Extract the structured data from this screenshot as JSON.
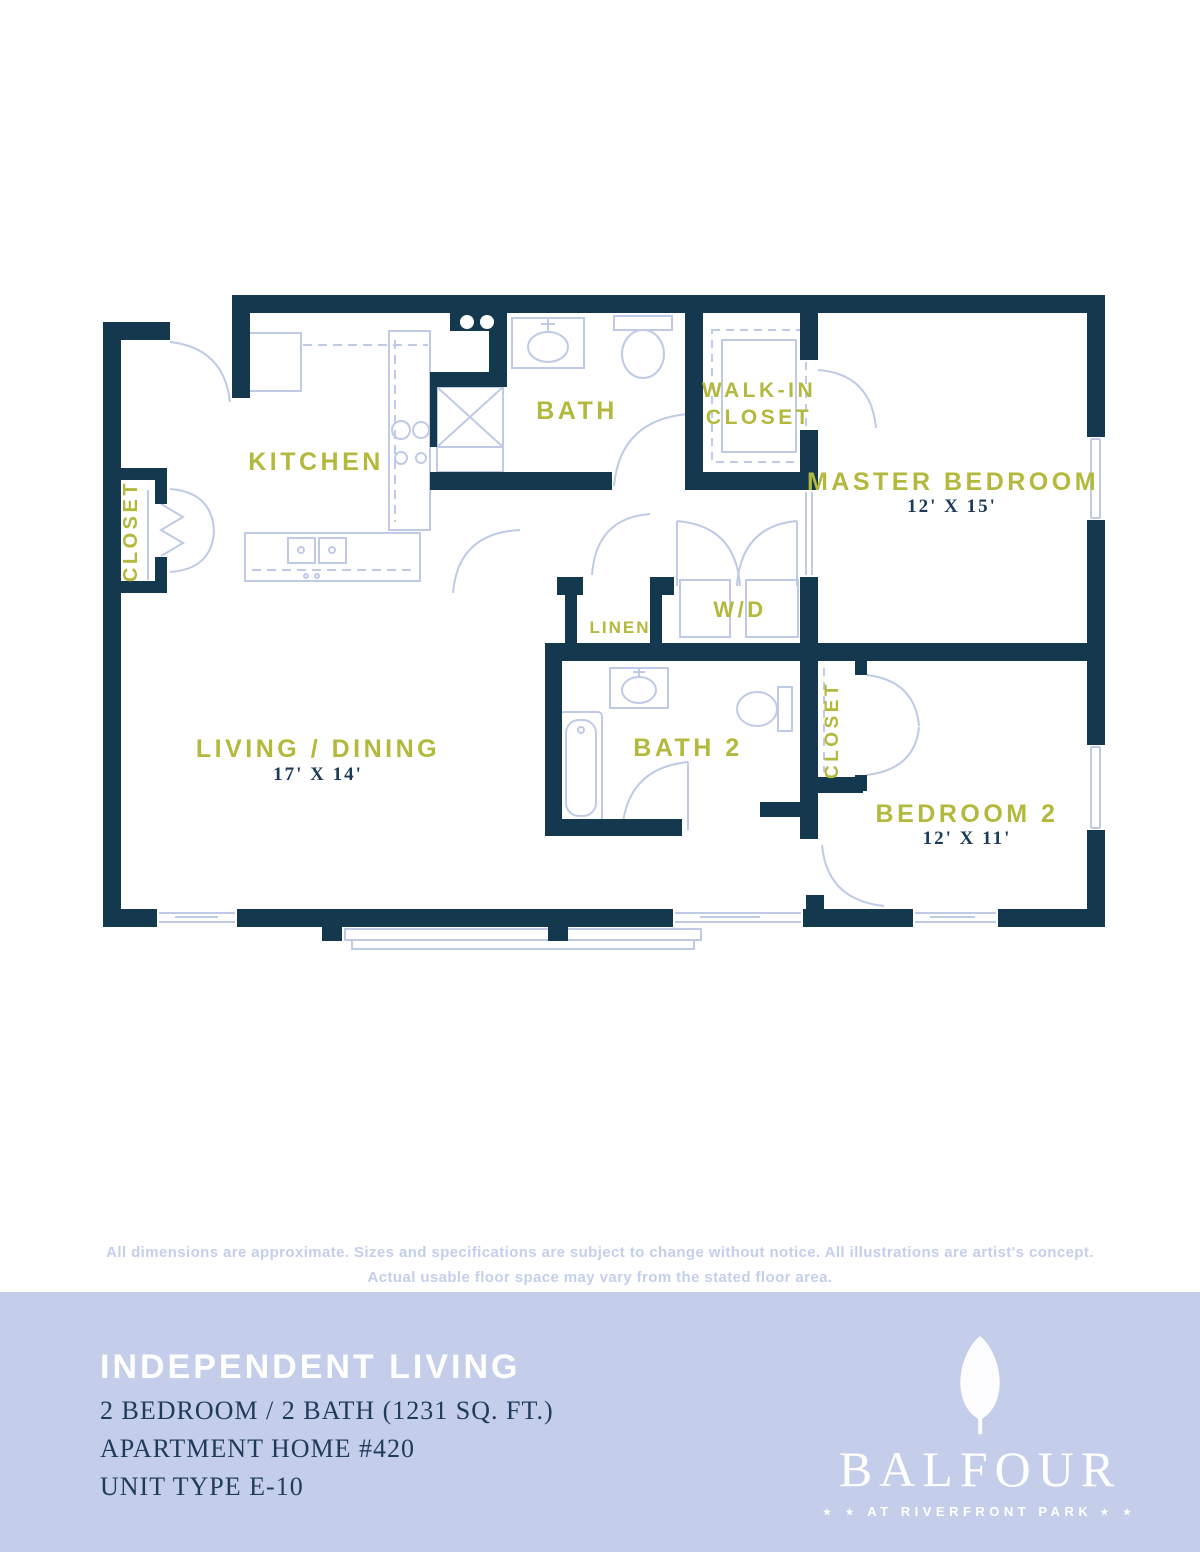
{
  "colors": {
    "wall_navy": "#14384e",
    "fixture_blue": "#bfcae6",
    "label_olive": "#b2b93c",
    "dims_navy": "#1c3a57",
    "band_periwinkle": "#c4cde9",
    "disclaimer_blue": "#c4cfec",
    "footer_text_navy": "#1e3c5a",
    "logo_white": "#ffffff"
  },
  "floorplan": {
    "labels": {
      "kitchen": "KITCHEN",
      "bath": "BATH",
      "walkin_line1": "WALK-IN",
      "walkin_line2": "CLOSET",
      "master": "MASTER BEDROOM",
      "master_dims": "12' X 15'",
      "entry_closet": "CLOSET",
      "linen": "LINEN",
      "wd": "W/D",
      "living": "LIVING / DINING",
      "living_dims": "17' X 14'",
      "bath2": "BATH 2",
      "closet2": "CLOSET",
      "bedroom2": "BEDROOM 2",
      "bedroom2_dims": "12' X 11'"
    }
  },
  "disclaimer": {
    "line1": "All dimensions are approximate. Sizes and specifications are subject to change without notice. All illustrations are artist's concept.",
    "line2": "Actual usable floor space may vary from the stated floor area."
  },
  "footer": {
    "heading": "INDEPENDENT LIVING",
    "line1": "2 BEDROOM / 2 BATH (1231 SQ. FT.)",
    "line2": "APARTMENT HOME #420",
    "line3": "UNIT TYPE E-10",
    "brand": "BALFOUR",
    "tagline": "AT RIVERFRONT PARK",
    "stars": "★ ★"
  }
}
